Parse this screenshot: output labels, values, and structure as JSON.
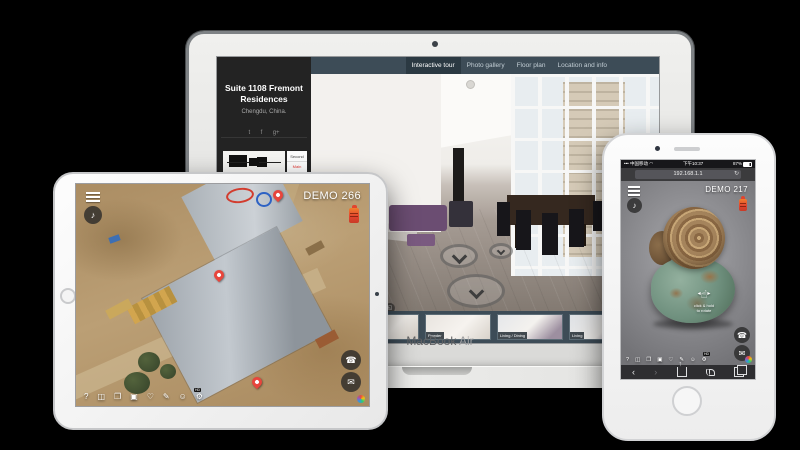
{
  "macbook": {
    "device_label": {
      "name": "MacBook",
      "model": "Air"
    },
    "nav_tabs": [
      {
        "label": "Interactive tour",
        "selected": true
      },
      {
        "label": "Photo gallery",
        "selected": false
      },
      {
        "label": "Floor plan",
        "selected": false
      },
      {
        "label": "Location and info",
        "selected": false
      }
    ],
    "sidebar": {
      "title": "Suite 1108 Fremont Residences",
      "subtitle": "Chengdu, China.",
      "social": [
        {
          "name": "twitter-icon",
          "glyph": "t"
        },
        {
          "name": "facebook-icon",
          "glyph": "f"
        },
        {
          "name": "google-plus-icon",
          "glyph": "g+"
        }
      ],
      "floor_selector": {
        "second": "Second",
        "main": "Main"
      }
    },
    "thumbnails": [
      {
        "label": ""
      },
      {
        "label": "Entry"
      },
      {
        "label": "Powder"
      },
      {
        "label": "Living / Dining"
      },
      {
        "label": "Living"
      }
    ]
  },
  "ipad": {
    "demo_label": "DEMO 266",
    "hd_badge": "HD"
  },
  "iphone": {
    "status": {
      "signal": "•••",
      "carrier": "中国移动",
      "wifi": "◠",
      "time": "下午10:37",
      "battery": "87%"
    },
    "address_bar": "192.168.1.1",
    "demo_label": "DEMO 217",
    "rotate_hint": {
      "line1": "click & hold",
      "line2": "to rotate"
    }
  },
  "tour_toolbar": [
    {
      "name": "help-icon",
      "glyph": "?"
    },
    {
      "name": "vr-icon",
      "glyph": "◫"
    },
    {
      "name": "gallery-icon",
      "glyph": "❐"
    },
    {
      "name": "camera-icon",
      "glyph": "▣"
    },
    {
      "name": "favorite-icon",
      "glyph": "♡"
    },
    {
      "name": "annotate-icon",
      "glyph": "✎"
    },
    {
      "name": "smiley-icon",
      "glyph": "☺"
    },
    {
      "name": "settings-icon",
      "glyph": "⚙"
    }
  ],
  "glyphs": {
    "music_note": "♪",
    "phone": "☎",
    "envelope": "✉",
    "refresh": "↻",
    "fullscreen": "◱",
    "back": "‹",
    "forward": "›"
  },
  "colors": {
    "navbar": "#3d4c57",
    "navbar_selected": "#2b3942",
    "accent_red": "#e2442e",
    "pin_red": "#e8453c",
    "floor_main_red": "#e53935"
  }
}
